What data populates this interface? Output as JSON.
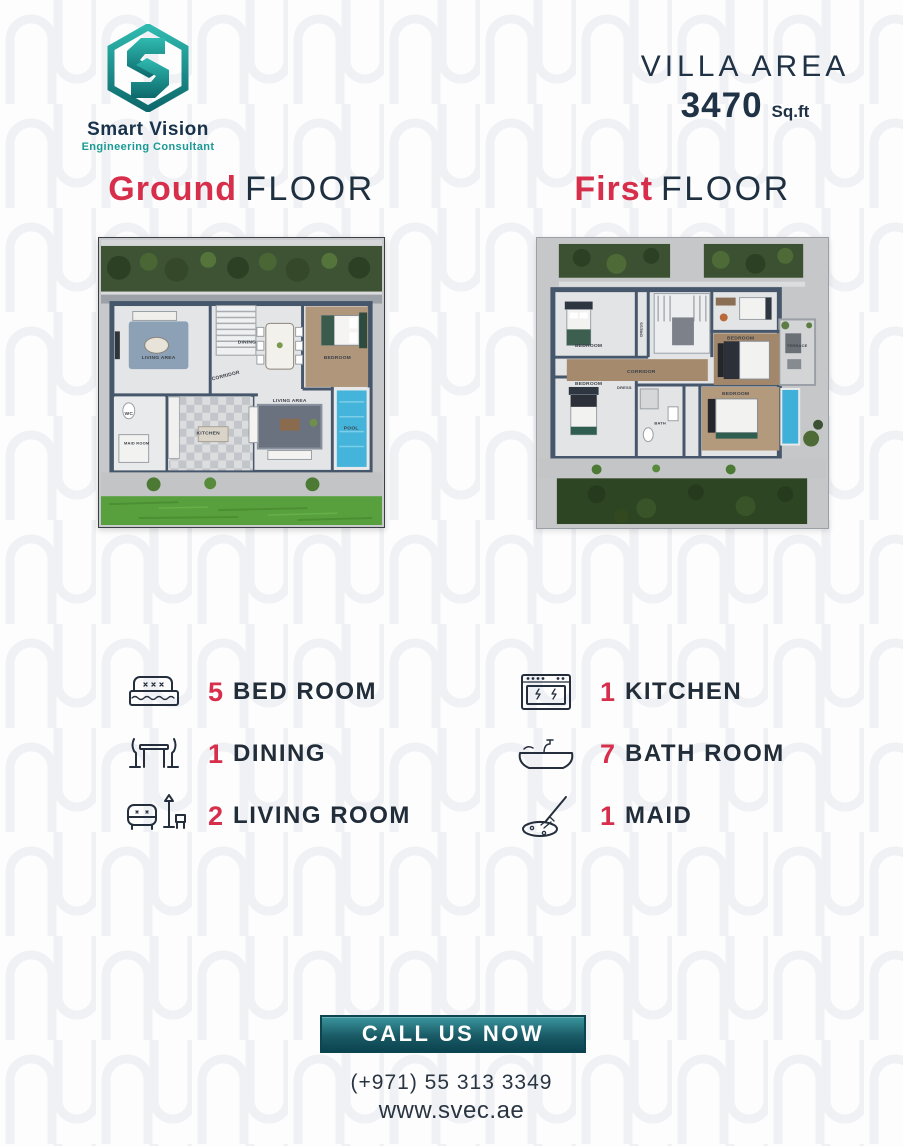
{
  "brand": {
    "name": "Smart Vision",
    "tagline": "Engineering Consultant"
  },
  "header": {
    "villa_area_label": "VILLA AREA",
    "villa_area_value": "3470",
    "villa_area_unit": "Sq.ft"
  },
  "floor_headings": {
    "ground_accent": "Ground",
    "ground_rest": "FLOOR",
    "first_accent": "First",
    "first_rest": "FLOOR"
  },
  "ground_plan": {
    "labels": {
      "living_area": "LIVING AREA",
      "dining": "DINING",
      "bedroom": "BEDROOM",
      "corridor": "CORRIDOR",
      "kitchen": "KITCHEN",
      "living_area_2": "LIVING AREA",
      "wc": "WC",
      "maid_room": "MAID ROOM",
      "pool": "POOL"
    }
  },
  "first_plan": {
    "labels": {
      "bedroom_1": "BEDROOM",
      "dress_1": "DRESS",
      "corridor": "CORRIDOR",
      "bedroom_2": "BEDROOM",
      "terrace": "TERRACE",
      "bedroom_3": "BEDROOM",
      "bedroom_4": "BEDROOM",
      "dress_2": "DRESS",
      "bath": "BATH"
    }
  },
  "features": {
    "left": [
      {
        "icon": "bed-icon",
        "count": "5",
        "label": "BED ROOM"
      },
      {
        "icon": "dining-icon",
        "count": "1",
        "label": "DINING"
      },
      {
        "icon": "living-room-icon",
        "count": "2",
        "label": "LIVING ROOM"
      }
    ],
    "right": [
      {
        "icon": "kitchen-stove-icon",
        "count": "1",
        "label": "KITCHEN"
      },
      {
        "icon": "bathtub-icon",
        "count": "7",
        "label": "BATH ROOM"
      },
      {
        "icon": "maid-mop-icon",
        "count": "1",
        "label": "MAID"
      }
    ]
  },
  "cta": {
    "button_label": "CALL US NOW",
    "phone": "(+971) 55 313 3349",
    "website": "www.svec.ae"
  },
  "colors": {
    "accent_red": "#d62e4b",
    "navy": "#1e2f40",
    "teal": "#1b9d98",
    "teal_dark": "#0c4550",
    "grass_light": "#58a03d",
    "grass_dark": "#2e4523",
    "pool_blue": "#45b4da"
  }
}
